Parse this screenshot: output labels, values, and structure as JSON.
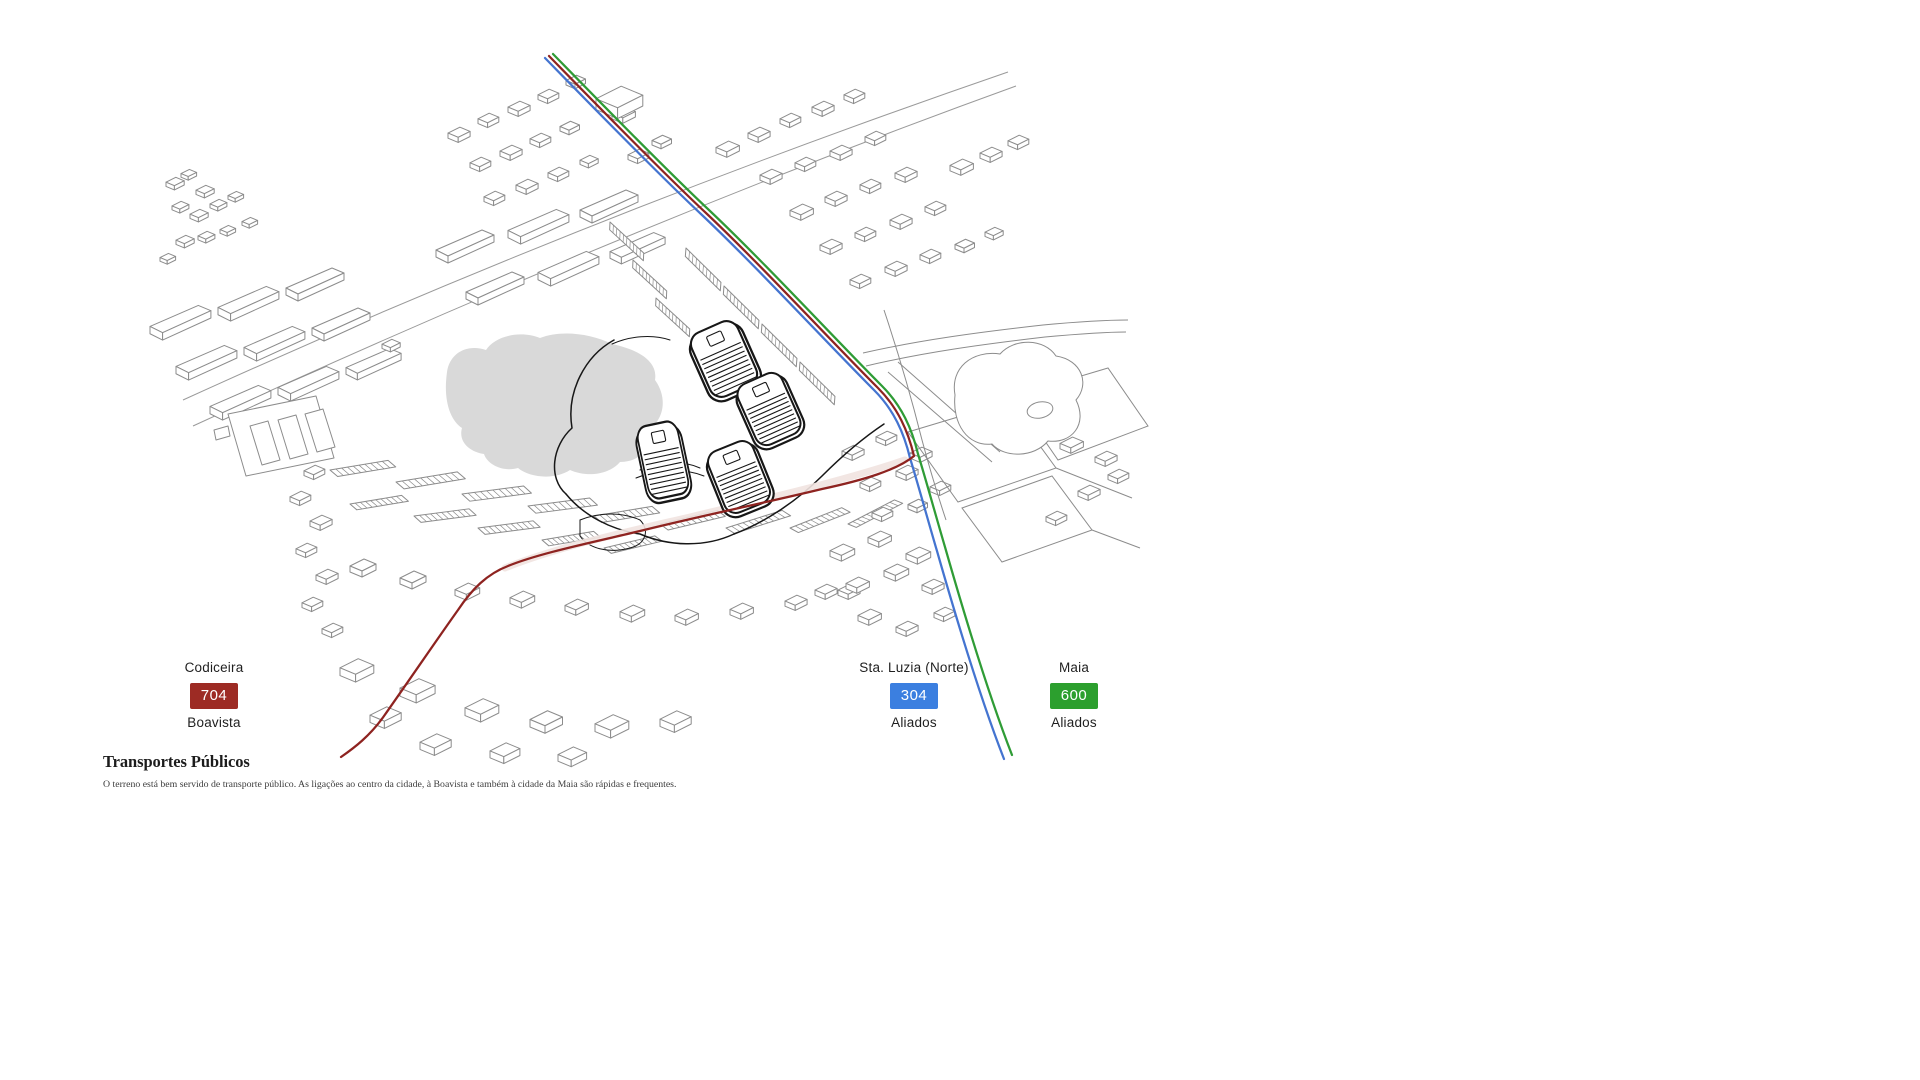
{
  "page": {
    "background": "#ffffff"
  },
  "section": {
    "title": "Transportes Públicos",
    "description": "O terreno está bem servido de transporte público. As ligações ao centro da cidade, à Boavista e também à cidade da Maia são rápidas e frequentes."
  },
  "routes": [
    {
      "number": "704",
      "origin": "Codiceira",
      "destination": "Boavista",
      "badge_color": "#9d2b24",
      "line_color": "#8e2320"
    },
    {
      "number": "304",
      "origin": "Sta. Luzia (Norte)",
      "destination": "Aliados",
      "badge_color": "#3b7fe0",
      "line_color": "#4474d0"
    },
    {
      "number": "600",
      "origin": "Maia",
      "destination": "Aliados",
      "badge_color": "#2c9f2e",
      "line_color": "#2f9c36"
    }
  ],
  "map": {
    "features": {
      "pond": "lake",
      "park": "park-with-paths",
      "towers": "development-towers",
      "housing": "surrounding-buildings"
    }
  },
  "css_vars": {
    "--c-build": "#8c8c8c",
    "--c-road": "#9a9a9a",
    "--c-pond": "#d9d9d9",
    "--c-site": "#171717",
    "--c-halo": "#f1e3e0"
  }
}
